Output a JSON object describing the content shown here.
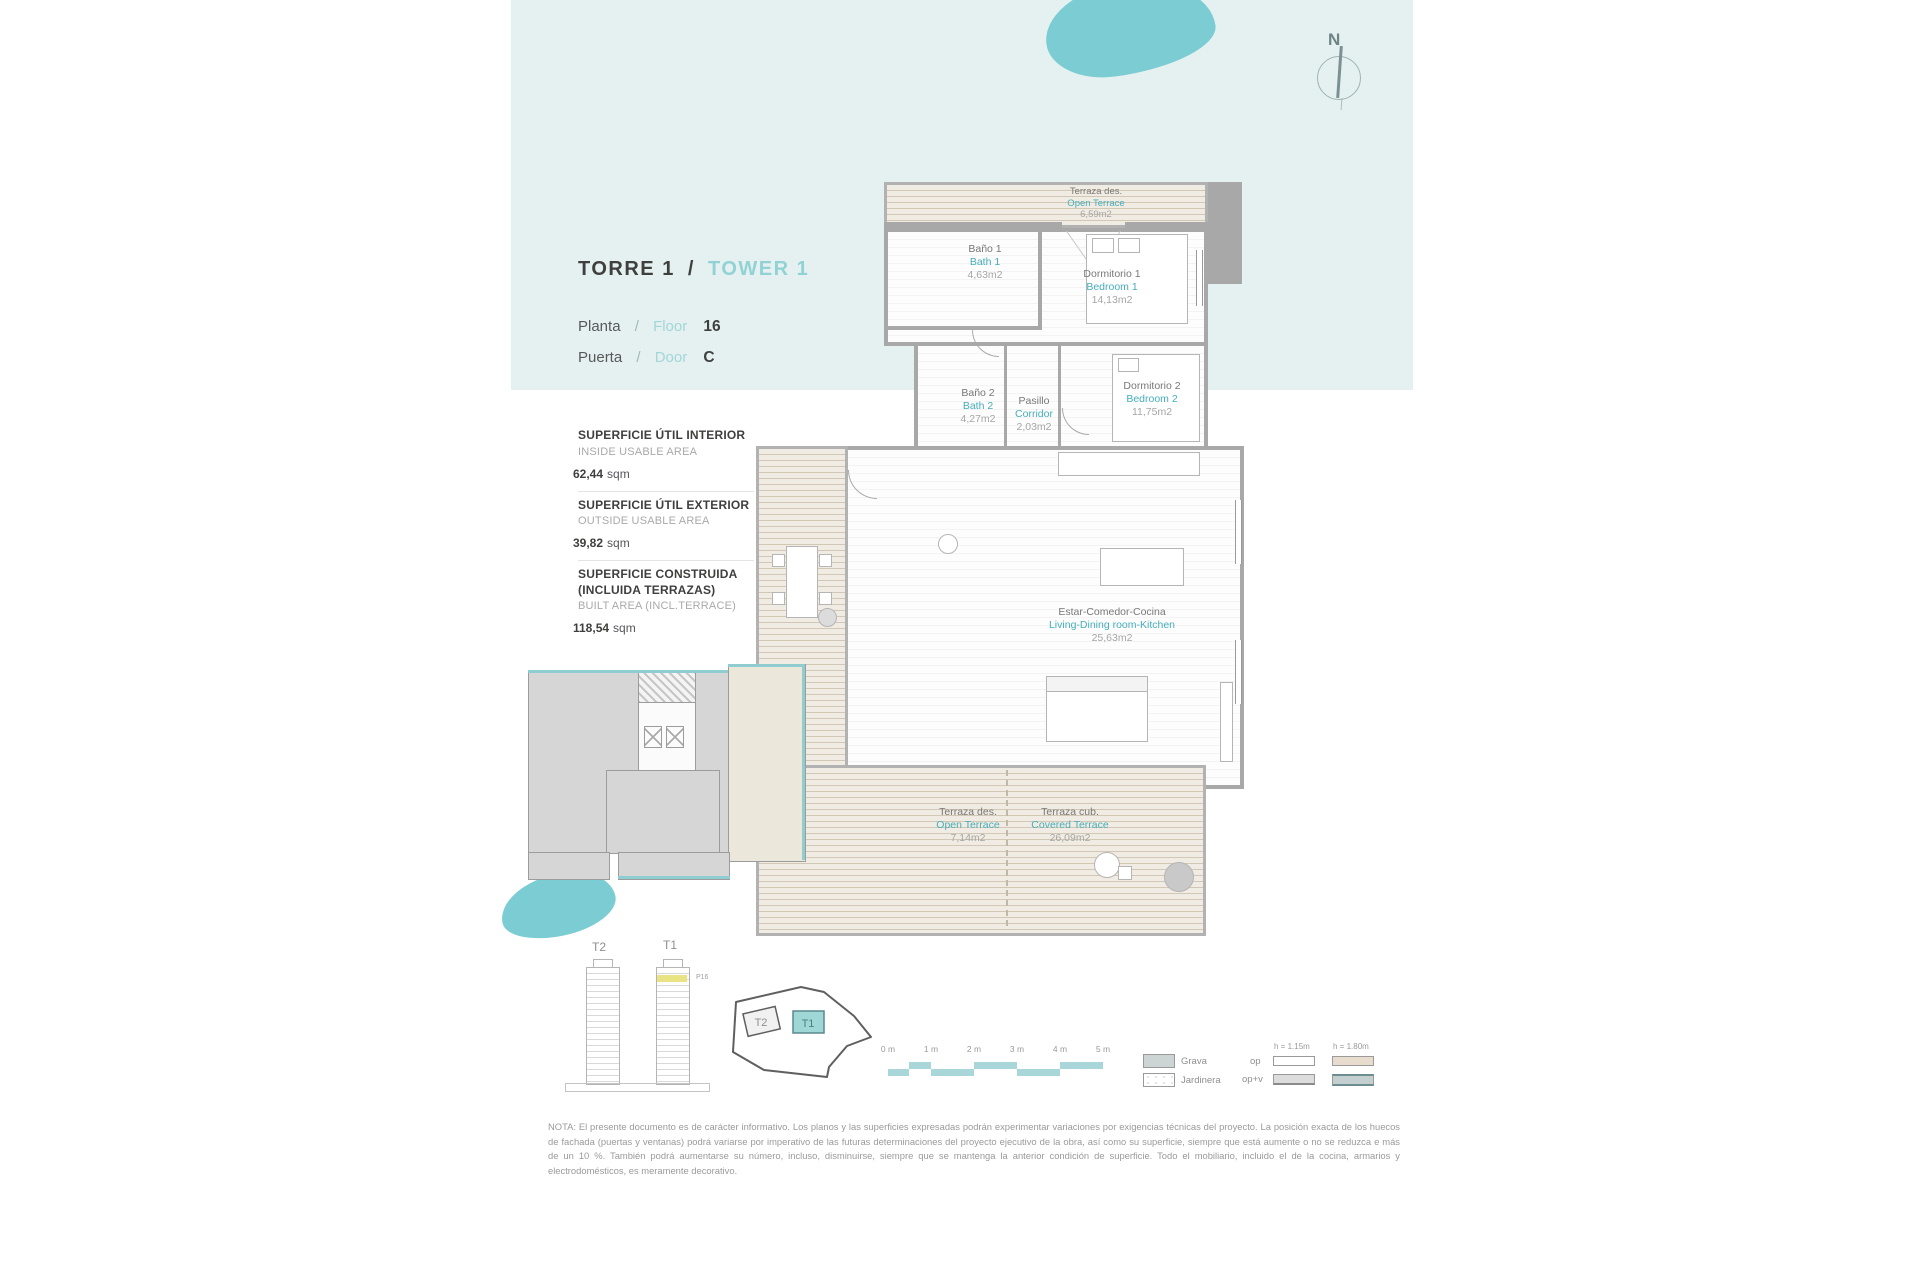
{
  "header": {
    "tower_es": "TORRE  1",
    "separator": "/",
    "tower_en": "TOWER  1",
    "floor_label_es": "Planta",
    "floor_label_en": "Floor",
    "floor_value": "16",
    "door_label_es": "Puerta",
    "door_label_en": "Door",
    "door_value": "C",
    "compass_n": "N"
  },
  "areas": [
    {
      "title_es": "SUPERFICIE ÚTIL INTERIOR",
      "title_en": "INSIDE USABLE AREA",
      "value": "62,44",
      "unit": "sqm"
    },
    {
      "title_es": "SUPERFICIE ÚTIL EXTERIOR",
      "title_en": "OUTSIDE USABLE AREA",
      "value": "39,82",
      "unit": "sqm"
    },
    {
      "title_es": "SUPERFICIE CONSTRUIDA (INCLUIDA TERRAZAS)",
      "title_en": "BUILT AREA (INCL.TERRACE)",
      "value": "118,54",
      "unit": "sqm"
    }
  ],
  "rooms": [
    {
      "es": "Terraza des.",
      "en": "Open Terrace",
      "area": "6,59m2"
    },
    {
      "es": "Baño 1",
      "en": "Bath 1",
      "area": "4,63m2"
    },
    {
      "es": "Dormitorio 1",
      "en": "Bedroom 1",
      "area": "14,13m2"
    },
    {
      "es": "Baño 2",
      "en": "Bath 2",
      "area": "4,27m2"
    },
    {
      "es": "Pasillo",
      "en": "Corridor",
      "area": "2,03m2"
    },
    {
      "es": "Dormitorio 2",
      "en": "Bedroom 2",
      "area": "11,75m2"
    },
    {
      "es": "Estar-Comedor-Cocina",
      "en": "Living-Dining room-Kitchen",
      "area": "25,63m2"
    },
    {
      "es": "Terraza des.",
      "en": "Open Terrace",
      "area": "7,14m2"
    },
    {
      "es": "Terraza cub.",
      "en": "Covered Terrace",
      "area": "26,09m2"
    }
  ],
  "towers": {
    "t2_label": "T2",
    "t1_label": "T1",
    "floor_tag": "P16"
  },
  "scale_bar": {
    "labels": [
      "0 m",
      "1 m",
      "2 m",
      "3 m",
      "4 m",
      "5 m"
    ]
  },
  "legend": {
    "grava": "Grava",
    "jardinera": "Jardinera",
    "op": "op",
    "opv": "op+v",
    "h1": "h = 1.15m",
    "h2": "h = 1.80m"
  },
  "note": "NOTA: El presente documento es de carácter informativo. Los planos y las superficies expresadas podrán experimentar variaciones por exigencias técnicas del proyecto. La posición exacta de los huecos de fachada (puertas y ventanas) podrá variarse por imperativo de las futuras determinaciones del proyecto ejecutivo de la obra, así como su superficie, siempre que está aumente o no se reduzca e más de un 10 %. También podrá aumentarse su número, incluso, disminuirse, siempre que se mantenga la anterior condición de superficie. Todo el mobiliario, incluido el de la cocina, armarios y electrodomésticos, es meramente decorativo.",
  "colors": {
    "band": "#e4f1f0",
    "teal_accent": "#7cccd3",
    "teal_text": "#45aebb",
    "highlight_yellow": "#e9e383",
    "terrace_beige": "#eae2d4"
  }
}
